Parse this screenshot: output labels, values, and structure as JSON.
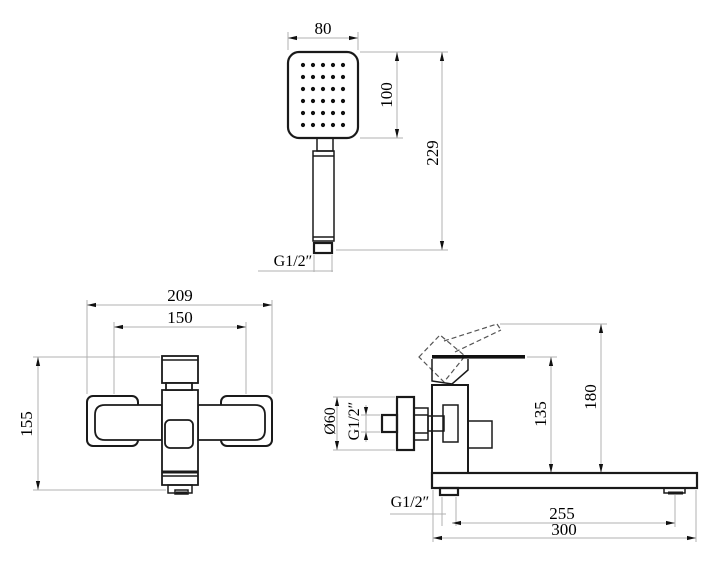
{
  "labels": {
    "shower": {
      "width": "80",
      "head_height": "100",
      "total_height": "229",
      "thread": "G1/2″"
    },
    "front": {
      "overall_width": "209",
      "inlet_centers": "150",
      "height": "155"
    },
    "side": {
      "flange_diameter": "Ø60",
      "wall_thread": "G1/2″",
      "body_height": "135",
      "total_height": "180",
      "outlet_thread": "G1/2″",
      "spout_reach": "255",
      "overall_length": "300"
    }
  },
  "spray_grid": {
    "cols": 5,
    "rows": 6
  },
  "colors": {
    "outline": "#1a1a1a",
    "dimension_line": "#b0b0b0",
    "hidden_line": "#555555",
    "text": "#000000",
    "background": "#ffffff"
  }
}
